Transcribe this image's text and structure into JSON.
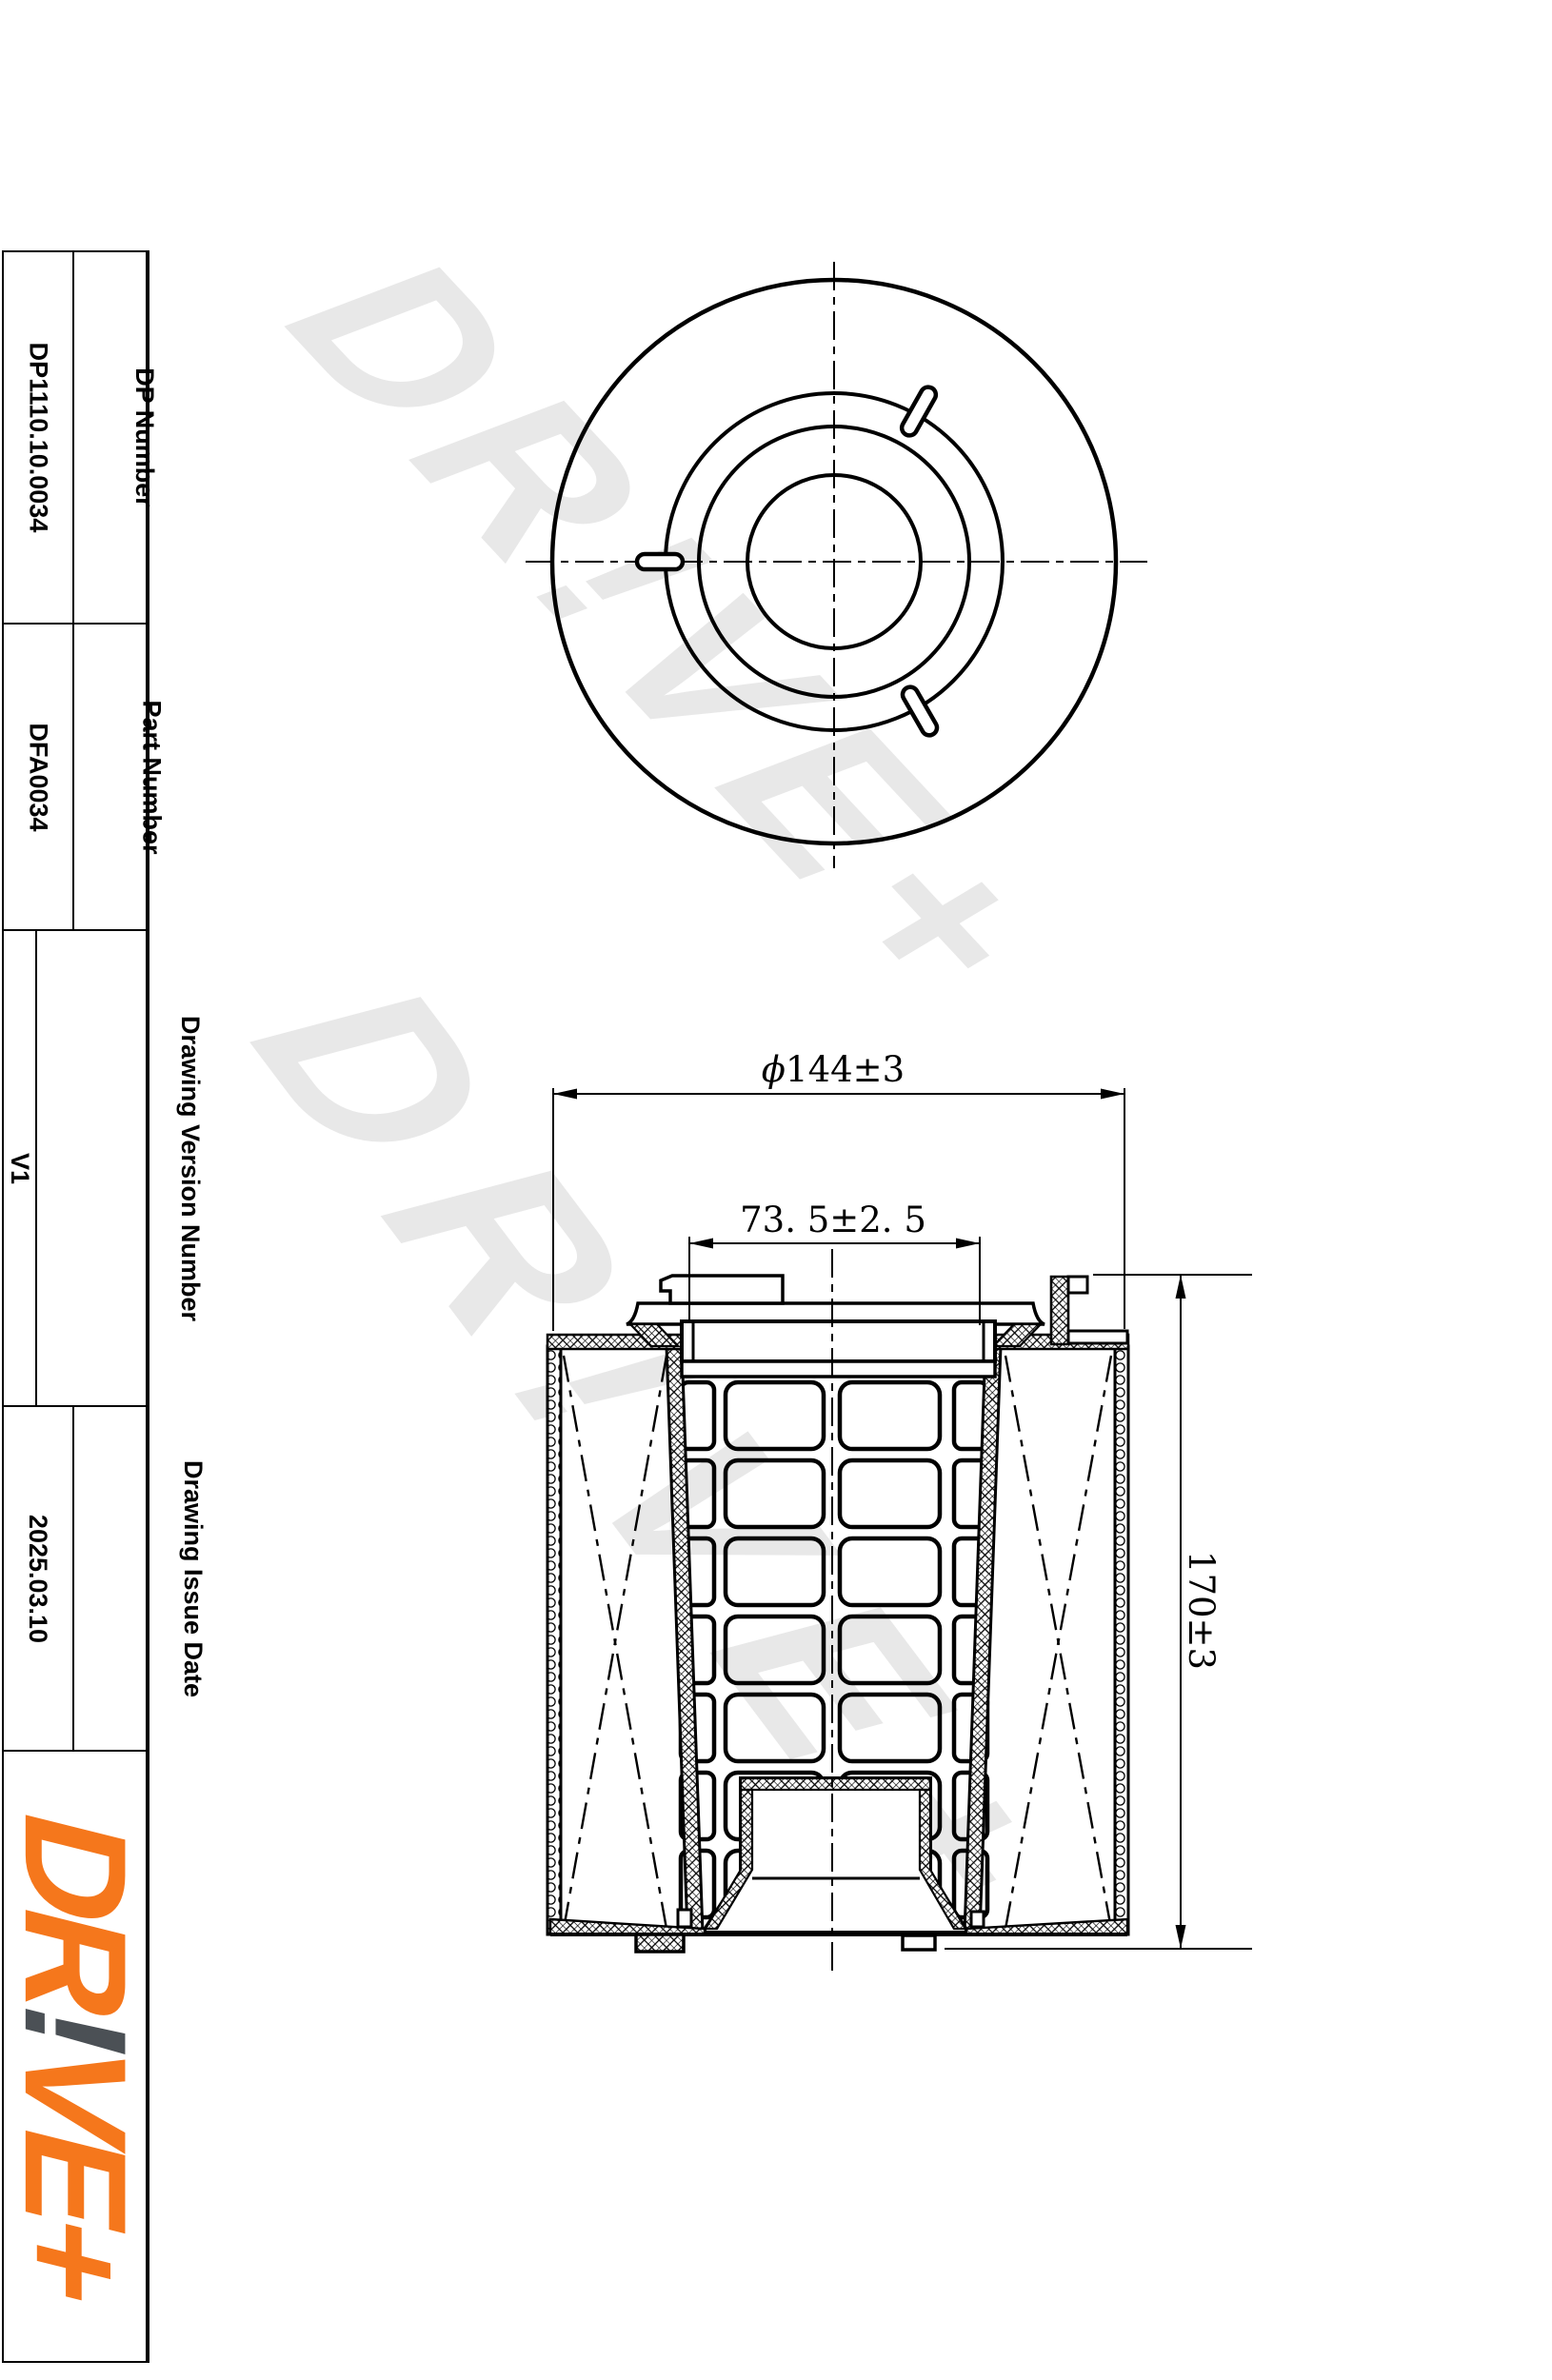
{
  "title_block": {
    "rows": [
      {
        "label": "DP Number",
        "value": "DP1110.10.0034"
      },
      {
        "label": "Part Number",
        "value": "DFA0034"
      },
      {
        "label": "Drawing Version Number",
        "value": "V1"
      },
      {
        "label": "Drawing Issue Date",
        "value": "2025.03.10"
      }
    ]
  },
  "logo": {
    "part1": "DR",
    "bang": "!",
    "part2": "VE+",
    "orange_color": "#f5771c",
    "gray_color": "#4b5055"
  },
  "watermark": {
    "text": "DR!VE+",
    "color": "#e8e8e8"
  },
  "dimensions": {
    "diameter": {
      "symbol": "ϕ",
      "text": "144±3"
    },
    "inner_width": {
      "text": "73. 5±2. 5"
    },
    "height": {
      "text": "170±3"
    }
  },
  "drawing": {
    "line_color": "#000000",
    "views": [
      "top-view",
      "section-view"
    ]
  }
}
